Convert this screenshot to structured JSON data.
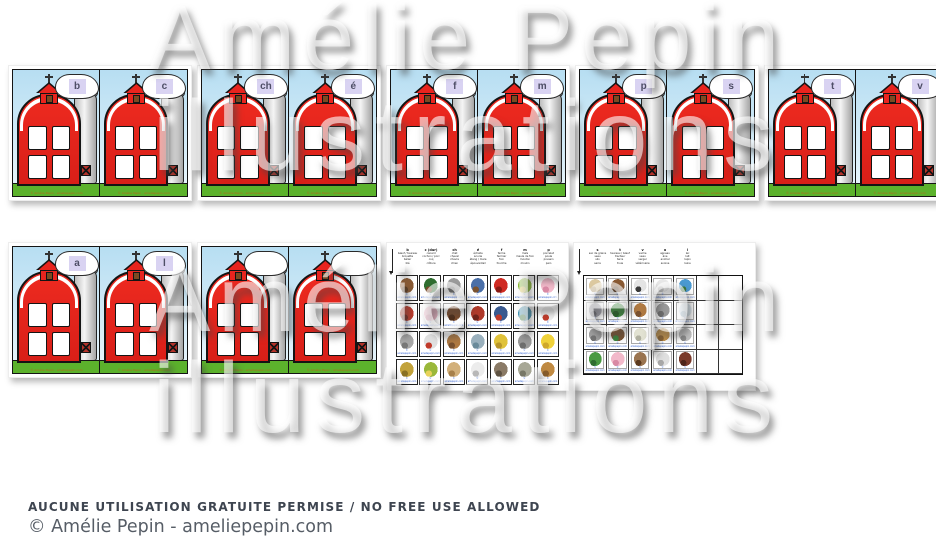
{
  "watermark": {
    "line1": "Amélie Pepin",
    "line2": "illustrations"
  },
  "footer": {
    "notice": "AUCUNE UTILISATION GRATUITE PERMISE / NO FREE USE ALLOWED",
    "credit": "© Amélie Pepin - ameliepepin.com"
  },
  "card_copyright": "© Amélie Pepin - ameliepepin.com",
  "cell_copyright": "© ameliepepin.com",
  "colors": {
    "barn_red": "#e8241e",
    "grass_green": "#5cb22c",
    "sky_blue": "#b7def2",
    "letter_chip": "#d9d3f2",
    "silo_gray": "#d0d0d0"
  },
  "rows": [
    {
      "pages": [
        {
          "type": "cards",
          "letters": [
            "b",
            "c"
          ]
        },
        {
          "type": "cards",
          "letters": [
            "ch",
            "é"
          ]
        },
        {
          "type": "cards",
          "letters": [
            "f",
            "m"
          ]
        },
        {
          "type": "cards",
          "letters": [
            "p",
            "s"
          ]
        },
        {
          "type": "cards",
          "letters": [
            "t",
            "v"
          ]
        }
      ]
    },
    {
      "pages": [
        {
          "type": "cards",
          "letters": [
            "a",
            "l"
          ]
        },
        {
          "type": "cards",
          "letters": [
            "",
            ""
          ]
        },
        {
          "type": "sheet",
          "sheet": 0
        },
        {
          "type": "sheet",
          "sheet": 1
        }
      ]
    }
  ],
  "sheets": [
    {
      "columns": [
        {
          "letter": "b",
          "words": [
            "bœuf / taureau",
            "brouette",
            "bélier",
            "blé"
          ]
        },
        {
          "letter": "c (dur)",
          "words": [
            "canard",
            "cochon / porc",
            "coq",
            "clôture"
          ]
        },
        {
          "letter": "ch",
          "words": [
            "chat",
            "cheval",
            "chèvre",
            "chien"
          ]
        },
        {
          "letter": "é",
          "words": [
            "échelle",
            "écurie",
            "étang / mare",
            "épouvantail"
          ]
        },
        {
          "letter": "f",
          "words": [
            "ferme",
            "fermier",
            "foin",
            "fourche"
          ]
        },
        {
          "letter": "m",
          "words": [
            "maïs",
            "meule de foin",
            "mouton",
            "moulin"
          ]
        },
        {
          "letter": "p",
          "words": [
            "porcelet",
            "poule",
            "poussin",
            "pain"
          ]
        }
      ],
      "cells": [
        [
          [
            "#8a5a33",
            "#5c3a1e"
          ],
          [
            "#2f6d2f",
            "#7a4a2a"
          ],
          [
            "#9b9b9b",
            "#6e6e6e"
          ],
          [
            "#4a6fa8",
            "#7a5230"
          ],
          [
            "#cf2a22",
            "#8a1a14"
          ],
          [
            "#8fbe3a",
            "#e8d25a"
          ],
          [
            "#f2b9ca",
            "#d98aa5"
          ]
        ],
        [
          [
            "#c03a2a",
            "#7a241a"
          ],
          [
            "#f2b9ca",
            "#d98aa5"
          ],
          [
            "#7a4a2a",
            "#4e2d18"
          ],
          [
            "#b03a2a",
            "#70241a"
          ],
          [
            "#3a5a8f",
            "#c03a2a"
          ],
          [
            "#4a9ab8",
            "#3a7a3a"
          ],
          [
            "#ececec",
            "#c03a2a"
          ]
        ],
        [
          [
            "#a8a8a8",
            "#787878"
          ],
          [
            "#e0e0e0",
            "#c03a2a"
          ],
          [
            "#b07a42",
            "#7a5230"
          ],
          [
            "#9ab0bd",
            "#6a8a9a"
          ],
          [
            "#e0c23a",
            "#b8962a"
          ],
          [
            "#9a9a9a",
            "#6e6e6e"
          ],
          [
            "#f0d23a",
            "#cfa82a"
          ]
        ],
        [
          [
            "#c2a23a",
            "#8a7224"
          ],
          [
            "#9ab83a",
            "#e8d25a"
          ],
          [
            "#d2b07a",
            "#a8814a"
          ],
          [
            "#ececec",
            "#b8b8b8"
          ],
          [
            "#8a7a66",
            "#5e5242"
          ],
          [
            "#a8a896",
            "#787866"
          ],
          [
            "#c08a42",
            "#8a5e2a"
          ]
        ]
      ],
      "empty_columns": 0
    },
    {
      "columns": [
        {
          "letter": "s",
          "words": [
            "sac de grains",
            "seau",
            "silo",
            "serre"
          ]
        },
        {
          "letter": "t",
          "words": [
            "taureau / bœuf",
            "tracteur",
            "terre",
            "truie"
          ]
        },
        {
          "letter": "v",
          "words": [
            "vache",
            "veau",
            "verger",
            "vétérinaire"
          ]
        },
        {
          "letter": "a",
          "words": [
            "agneau",
            "âne",
            "animal",
            "avoine"
          ]
        },
        {
          "letter": "l",
          "words": [
            "lac",
            "lait",
            "lapin",
            "laine"
          ]
        }
      ],
      "cells": [
        [
          [
            "#dcc9a0",
            "#b09a6e"
          ],
          [
            "#8a5a33",
            "#5c3a1e"
          ],
          [
            "#e4e4e4",
            "#3a3a3a"
          ],
          [
            "#e8e8e8",
            "#b8b8b8"
          ],
          [
            "#4a9ad2",
            "#3a7a3a"
          ]
        ],
        [
          [
            "#a8a8b2",
            "#74747e"
          ],
          [
            "#3a8a3a",
            "#246224"
          ],
          [
            "#b07a42",
            "#7a5230"
          ],
          [
            "#9a9a9a",
            "#6e6e6e"
          ],
          [
            "#dce8f0",
            "#a8c2d2"
          ]
        ],
        [
          [
            "#a0a0a0",
            "#747474"
          ],
          [
            "#7a5230",
            "#3a8a3a"
          ],
          [
            "#e2e2d2",
            "#b0b0a0"
          ],
          [
            "#c2924a",
            "#8a6230"
          ],
          [
            "#bdbdbd",
            "#8a8a8a"
          ]
        ],
        [
          [
            "#4a9a42",
            "#2f6d2f"
          ],
          [
            "#f2b9ca",
            "#d98aa5"
          ],
          [
            "#9a7450",
            "#5c3a1e"
          ],
          [
            "#e0e0e0",
            "#a8a8a8"
          ],
          [
            "#7a3a2a",
            "#4e2418"
          ]
        ]
      ],
      "empty_columns": 2
    }
  ]
}
